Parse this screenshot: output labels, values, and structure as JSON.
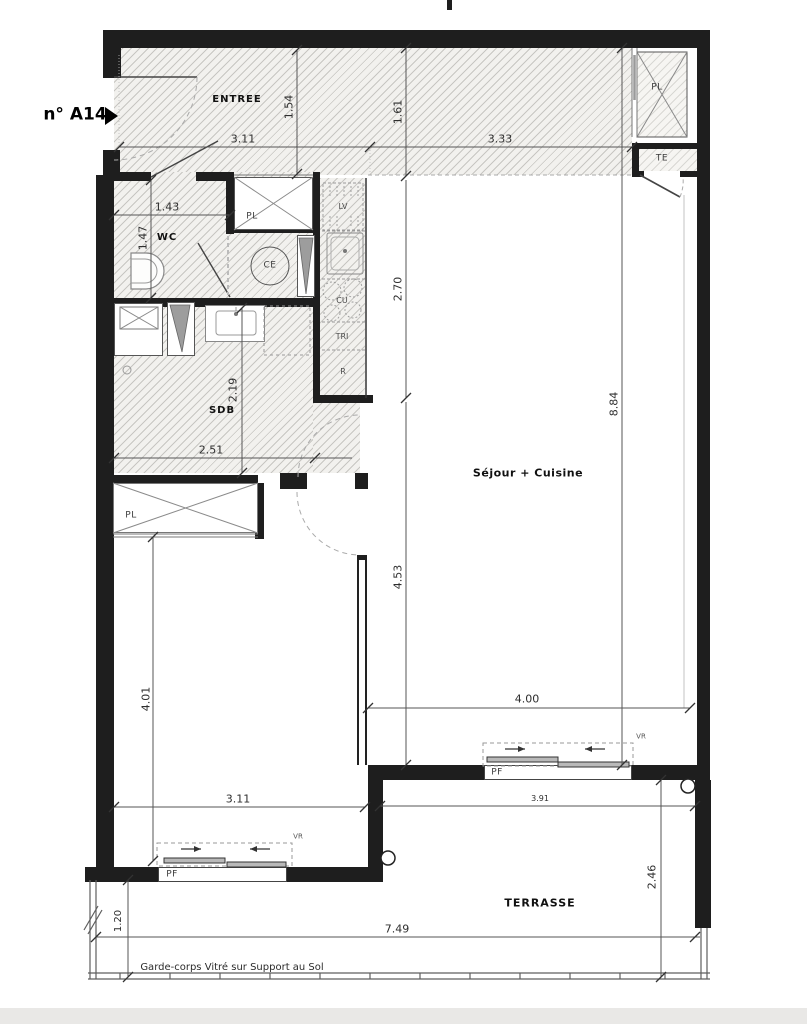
{
  "page": {
    "background": "#ffffff",
    "footer_band_color": "#e9e8e6"
  },
  "plan": {
    "unit_label": "n° A14",
    "colors": {
      "wall": "#1e1e1e",
      "hatch_line": "#82807a",
      "dim_line": "#555555"
    },
    "rooms": {
      "entree": "ENTREE",
      "wc": "WC",
      "sdb": "SDB",
      "sejour": "Séjour + Cuisine",
      "terrasse": "TERRASSE"
    },
    "fixtures": {
      "pl": "PL",
      "te": "TE",
      "ce": "CE",
      "lv": "LV",
      "cu": "CU",
      "tri": "TRI",
      "r": "R",
      "pf": "PF",
      "vr": "VR"
    },
    "dimensions": {
      "d311a": "3.11",
      "d333": "3.33",
      "d154": "1.54",
      "d161": "1.61",
      "d143": "1.43",
      "d147": "1.47",
      "d270": "2.70",
      "d884": "8.84",
      "d453": "4.53",
      "d219": "2.19",
      "d251": "2.51",
      "d401": "4.01",
      "d311b": "3.11",
      "d400": "4.00",
      "d391": "3.91",
      "d246": "2.46",
      "d749": "7.49",
      "d120": "1.20"
    },
    "note": "Garde-corps Vitré sur Support au Sol"
  }
}
